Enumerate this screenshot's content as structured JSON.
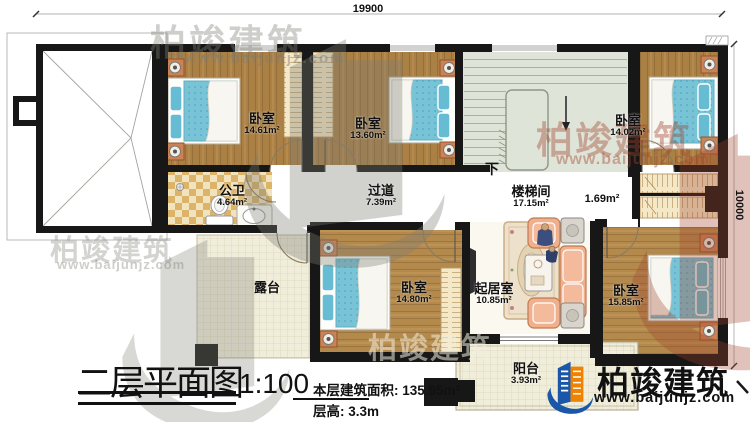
{
  "drawing": {
    "title": "二层平面图",
    "scale": "1:100",
    "floor_area_label": "本层建筑面积:",
    "floor_area_value": "135.95m²",
    "floor_height_label": "层高:",
    "floor_height_value": "3.3m"
  },
  "dimensions": {
    "top": "19900",
    "right": "10000"
  },
  "rooms": {
    "bedroom_top_left": {
      "label": "卧室",
      "area": "14.61m²"
    },
    "bedroom_top_middle": {
      "label": "卧室",
      "area": "13.60m²"
    },
    "bedroom_top_right": {
      "label": "卧室",
      "area": "14.02m²"
    },
    "bathroom": {
      "label": "公卫",
      "area": "4.64m²"
    },
    "hallway": {
      "label": "过道",
      "area": "7.39m²"
    },
    "stairwell": {
      "label": "楼梯间",
      "area": "17.15m²",
      "down": "下"
    },
    "closet_nook": {
      "area": "1.69m²"
    },
    "bedroom_bottom_middle": {
      "label": "卧室",
      "area": "14.80m²"
    },
    "living_room": {
      "label": "起居室",
      "area": "10.85m²"
    },
    "bedroom_bottom_right": {
      "label": "卧室",
      "area": "15.85m²"
    },
    "terrace": {
      "label": "露台"
    },
    "balcony": {
      "label": "阳台",
      "area": "3.93m²"
    }
  },
  "branding": {
    "company": "柏竣建筑",
    "website": "www.baijunjz.com"
  },
  "colors": {
    "wall": "#171717",
    "wood_floor": "#ab8045",
    "bed": "#79c3d7",
    "stair_floor": "#dfe4d9",
    "terrace_floor": "#f0edda",
    "bathroom_tile": "#dcb469",
    "sofa": "#f0b08e",
    "logo_blue": "#1a57a8",
    "logo_orange": "#ef8200"
  }
}
